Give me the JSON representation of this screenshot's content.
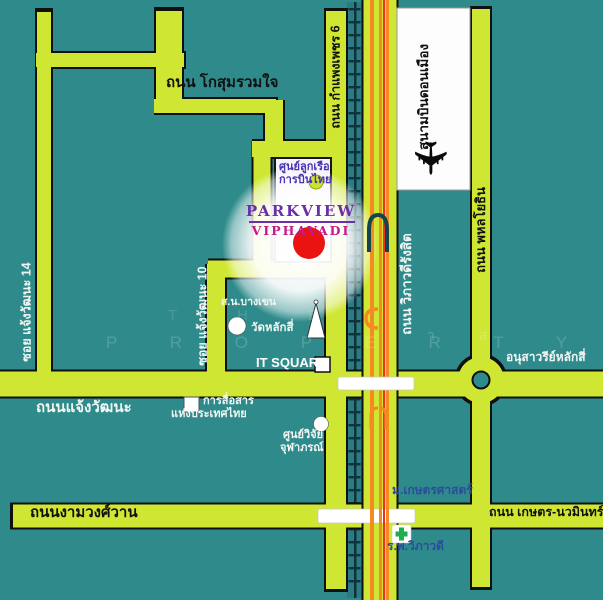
{
  "colors": {
    "background": "#2f8b8b",
    "road": "#cfe732",
    "highway_stripe_orange": "#f6891f",
    "highway_stripe_red": "#e93323",
    "marker_red": "#ea1311",
    "parkview_purple": "#6b2fa8",
    "viphavadi_magenta": "#c4198f",
    "hospital_green": "#1fae4e"
  },
  "roads": {
    "kosum": "ถนน โกสุมรวมใจ",
    "soi14": "ซอย แจ้งวัฒนะ 14",
    "soi10": "ซอย แจ้งวัฒนะ 10",
    "kamphaeng_phet_6": "ถนน กำแพงเพชร 6",
    "vibhavadi_rangsit": "ถนน วิภาวดีรังสิต",
    "phahonyothin": "ถนน พหลโยธิน",
    "chaengwatthana": "ถนนแจ้งวัฒนะ",
    "ngamwongwan": "ถนนงามวงศ์วาน",
    "kaset_nawamin": "ถนน เกษตร-นวมินทร์"
  },
  "places": {
    "airport": "สนามบินดอนเมือง",
    "crew_center_line1": "ศูนย์ลูกเรือ",
    "crew_center_line2": "การบินไทย",
    "project_name": "PARKVIEW",
    "project_subname": "VIPHAVADI",
    "police_station": "ส.น.บางเขน",
    "wat_lak_si": "วัดหลักสี่",
    "it_square": "IT SQUARE",
    "cat_telecom_line1": "การสื่อสาร",
    "cat_telecom_line2": "แห่งประเทศไทย",
    "chulabhorn_line1": "ศูนย์วิจัย",
    "chulabhorn_line2": "จุฬาภรณ์",
    "lak_si_monument": "อนุสาวรีย์หลักสี่",
    "kasetsart_university": "ม.เกษตรศาสตร์",
    "vibhavadi_hospital": "ร.พ.วิภาวดี"
  },
  "icons": {
    "airplane": "✈"
  },
  "watermark": {
    "line1": "T H E",
    "line2": "P R O P E R T Y",
    "fragment": "า ส"
  }
}
